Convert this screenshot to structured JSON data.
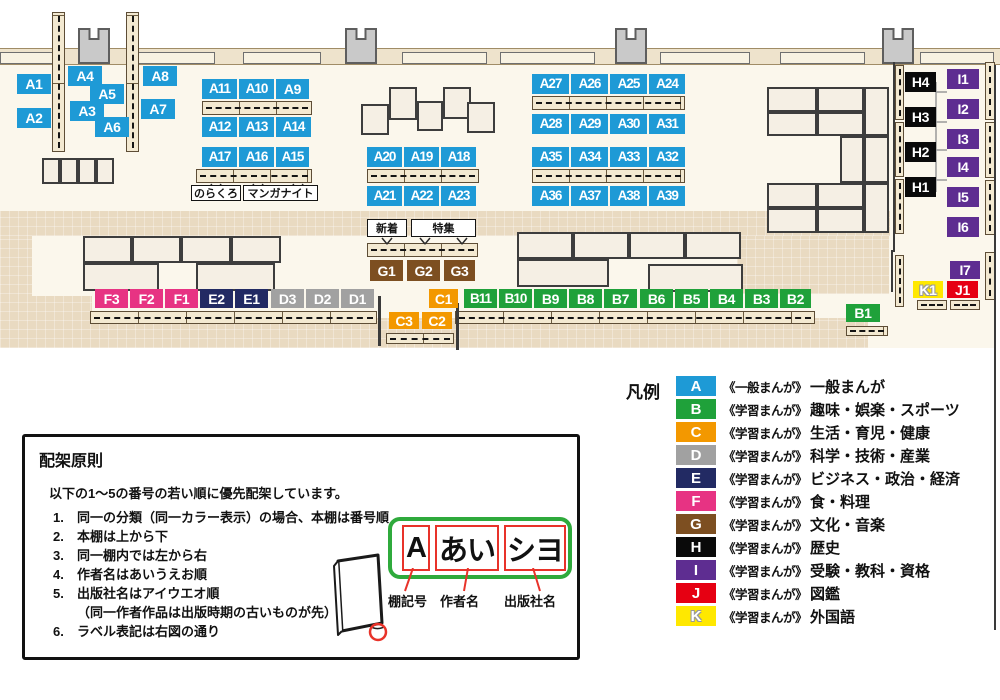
{
  "category_colors": {
    "A": "#1e9ad6",
    "B": "#1fa13a",
    "C": "#f39800",
    "D": "#a1a1a1",
    "E": "#222a63",
    "F": "#e73383",
    "G": "#7d4f21",
    "H": "#0a0a0a",
    "I": "#5e2d91",
    "J": "#e60012",
    "K": "#ffe800"
  },
  "map": {
    "shelf_labels": [
      {
        "id": "A1",
        "r": [
          17,
          74,
          34,
          20
        ]
      },
      {
        "id": "A4",
        "r": [
          68,
          66,
          34,
          20
        ]
      },
      {
        "id": "A8",
        "r": [
          143,
          66,
          34,
          20
        ]
      },
      {
        "id": "A5",
        "r": [
          90,
          84,
          34,
          20
        ]
      },
      {
        "id": "A2",
        "r": [
          17,
          108,
          34,
          20
        ]
      },
      {
        "id": "A3",
        "r": [
          70,
          101,
          34,
          20
        ]
      },
      {
        "id": "A7",
        "r": [
          141,
          99,
          34,
          20
        ]
      },
      {
        "id": "A6",
        "r": [
          95,
          117,
          34,
          20
        ]
      },
      {
        "id": "A11",
        "r": [
          202,
          79,
          35,
          20
        ]
      },
      {
        "id": "A10",
        "r": [
          239,
          79,
          35,
          20
        ]
      },
      {
        "id": "A9",
        "r": [
          276,
          79,
          33,
          20
        ]
      },
      {
        "id": "A12",
        "r": [
          202,
          117,
          35,
          20
        ]
      },
      {
        "id": "A13",
        "r": [
          239,
          117,
          35,
          20
        ]
      },
      {
        "id": "A14",
        "r": [
          276,
          117,
          35,
          20
        ]
      },
      {
        "id": "A17",
        "r": [
          202,
          147,
          35,
          20
        ]
      },
      {
        "id": "A16",
        "r": [
          239,
          147,
          35,
          20
        ]
      },
      {
        "id": "A15",
        "r": [
          276,
          147,
          33,
          20
        ]
      },
      {
        "id": "A20",
        "r": [
          367,
          147,
          35,
          20
        ]
      },
      {
        "id": "A19",
        "r": [
          404,
          147,
          35,
          20
        ]
      },
      {
        "id": "A18",
        "r": [
          441,
          147,
          35,
          20
        ]
      },
      {
        "id": "A21",
        "r": [
          367,
          186,
          35,
          20
        ]
      },
      {
        "id": "A22",
        "r": [
          404,
          186,
          35,
          20
        ]
      },
      {
        "id": "A23",
        "r": [
          441,
          186,
          35,
          20
        ]
      },
      {
        "id": "A27",
        "r": [
          532,
          74,
          37,
          20
        ]
      },
      {
        "id": "A26",
        "r": [
          571,
          74,
          37,
          20
        ]
      },
      {
        "id": "A25",
        "r": [
          610,
          74,
          37,
          20
        ]
      },
      {
        "id": "A24",
        "r": [
          649,
          74,
          36,
          20
        ]
      },
      {
        "id": "A28",
        "r": [
          532,
          114,
          37,
          20
        ]
      },
      {
        "id": "A29",
        "r": [
          571,
          114,
          37,
          20
        ]
      },
      {
        "id": "A30",
        "r": [
          610,
          114,
          37,
          20
        ]
      },
      {
        "id": "A31",
        "r": [
          649,
          114,
          36,
          20
        ]
      },
      {
        "id": "A35",
        "r": [
          532,
          147,
          37,
          20
        ]
      },
      {
        "id": "A34",
        "r": [
          571,
          147,
          37,
          20
        ]
      },
      {
        "id": "A33",
        "r": [
          610,
          147,
          37,
          20
        ]
      },
      {
        "id": "A32",
        "r": [
          649,
          147,
          36,
          20
        ]
      },
      {
        "id": "A36",
        "r": [
          532,
          186,
          37,
          20
        ]
      },
      {
        "id": "A37",
        "r": [
          571,
          186,
          37,
          20
        ]
      },
      {
        "id": "A38",
        "r": [
          610,
          186,
          37,
          20
        ]
      },
      {
        "id": "A39",
        "r": [
          649,
          186,
          36,
          20
        ]
      },
      {
        "id": "G1",
        "r": [
          370,
          260,
          33,
          21
        ]
      },
      {
        "id": "G2",
        "r": [
          407,
          260,
          33,
          21
        ]
      },
      {
        "id": "G3",
        "r": [
          444,
          260,
          31,
          21
        ]
      },
      {
        "id": "F3",
        "r": [
          95,
          289,
          33,
          19
        ]
      },
      {
        "id": "F2",
        "r": [
          130,
          289,
          33,
          19
        ]
      },
      {
        "id": "F1",
        "r": [
          165,
          289,
          33,
          19
        ]
      },
      {
        "id": "E2",
        "r": [
          200,
          289,
          33,
          19
        ]
      },
      {
        "id": "E1",
        "r": [
          235,
          289,
          33,
          19
        ]
      },
      {
        "id": "D3",
        "r": [
          271,
          289,
          33,
          19
        ]
      },
      {
        "id": "D2",
        "r": [
          306,
          289,
          33,
          19
        ]
      },
      {
        "id": "D1",
        "r": [
          341,
          289,
          33,
          19
        ]
      },
      {
        "id": "C1",
        "r": [
          429,
          289,
          29,
          19
        ]
      },
      {
        "id": "B11",
        "r": [
          464,
          289,
          33,
          19
        ]
      },
      {
        "id": "B10",
        "r": [
          499,
          289,
          33,
          19
        ]
      },
      {
        "id": "B9",
        "r": [
          534,
          289,
          33,
          19
        ]
      },
      {
        "id": "B8",
        "r": [
          569,
          289,
          33,
          19
        ]
      },
      {
        "id": "B7",
        "r": [
          604,
          289,
          33,
          19
        ]
      },
      {
        "id": "B6",
        "r": [
          640,
          289,
          33,
          19
        ]
      },
      {
        "id": "B5",
        "r": [
          675,
          289,
          33,
          19
        ]
      },
      {
        "id": "B4",
        "r": [
          710,
          289,
          33,
          19
        ]
      },
      {
        "id": "B3",
        "r": [
          745,
          289,
          33,
          19
        ]
      },
      {
        "id": "B2",
        "r": [
          780,
          289,
          31,
          19
        ]
      },
      {
        "id": "C3",
        "r": [
          389,
          312,
          30,
          17
        ]
      },
      {
        "id": "C2",
        "r": [
          422,
          312,
          30,
          17
        ]
      },
      {
        "id": "B1",
        "r": [
          846,
          304,
          34,
          18
        ]
      },
      {
        "id": "H4",
        "r": [
          905,
          72,
          31,
          20
        ]
      },
      {
        "id": "H3",
        "r": [
          905,
          107,
          31,
          20
        ]
      },
      {
        "id": "H2",
        "r": [
          905,
          142,
          31,
          20
        ]
      },
      {
        "id": "H1",
        "r": [
          905,
          177,
          31,
          20
        ]
      },
      {
        "id": "I1",
        "r": [
          947,
          69,
          32,
          20
        ]
      },
      {
        "id": "I2",
        "r": [
          947,
          99,
          32,
          20
        ]
      },
      {
        "id": "I3",
        "r": [
          947,
          129,
          32,
          20
        ]
      },
      {
        "id": "I4",
        "r": [
          947,
          157,
          32,
          20
        ]
      },
      {
        "id": "I5",
        "r": [
          947,
          187,
          32,
          20
        ]
      },
      {
        "id": "I6",
        "r": [
          947,
          217,
          32,
          20
        ]
      },
      {
        "id": "I7",
        "r": [
          950,
          261,
          30,
          18
        ]
      },
      {
        "id": "K1",
        "r": [
          913,
          281,
          30,
          17
        ]
      },
      {
        "id": "J1",
        "r": [
          947,
          281,
          31,
          17
        ]
      }
    ],
    "text_labels": [
      {
        "id": "norakuro",
        "text": "のらくろ",
        "r": [
          191,
          185,
          50,
          16
        ]
      },
      {
        "id": "manga-knight",
        "text": "マンガナイト",
        "r": [
          243,
          185,
          75,
          16
        ]
      },
      {
        "id": "new-arrivals",
        "text": "新着",
        "r": [
          367,
          219,
          40,
          18
        ]
      },
      {
        "id": "feature",
        "text": "特集",
        "r": [
          411,
          219,
          65,
          18
        ]
      }
    ]
  },
  "legend": {
    "title": "凡例",
    "items": [
      {
        "code": "A",
        "series": "《一般まんが》",
        "label": "一般まんが"
      },
      {
        "code": "B",
        "series": "《学習まんが》",
        "label": "趣味・娯楽・スポーツ"
      },
      {
        "code": "C",
        "series": "《学習まんが》",
        "label": "生活・育児・健康"
      },
      {
        "code": "D",
        "series": "《学習まんが》",
        "label": "科学・技術・産業"
      },
      {
        "code": "E",
        "series": "《学習まんが》",
        "label": "ビジネス・政治・経済"
      },
      {
        "code": "F",
        "series": "《学習まんが》",
        "label": "食・料理"
      },
      {
        "code": "G",
        "series": "《学習まんが》",
        "label": "文化・音楽"
      },
      {
        "code": "H",
        "series": "《学習まんが》",
        "label": "歴史"
      },
      {
        "code": "I",
        "series": "《学習まんが》",
        "label": "受験・教科・資格"
      },
      {
        "code": "J",
        "series": "《学習まんが》",
        "label": "図鑑"
      },
      {
        "code": "K",
        "series": "《学習まんが》",
        "label": "外国語"
      }
    ]
  },
  "principles": {
    "title": "配架原則",
    "intro": "以下の1～5の番号の若い順に優先配架しています。",
    "items": [
      {
        "n": "1.",
        "t": "同一の分類（同一カラー表示）の場合、本棚は番号順"
      },
      {
        "n": "2.",
        "t": "本棚は上から下"
      },
      {
        "n": "3.",
        "t": "同一棚内では左から右"
      },
      {
        "n": "4.",
        "t": "作者名はあいうえお順"
      },
      {
        "n": "5.",
        "t": "出版社名はアイウエオ順",
        "note": "（同一作者作品は出版時期の古いものが先）"
      },
      {
        "n": "6.",
        "t": "ラベル表記は右図の通り"
      }
    ]
  },
  "label_diagram": {
    "boxes": [
      {
        "text": "A",
        "w": 28
      },
      {
        "text": "あい",
        "w": 64
      },
      {
        "text": "シヨ",
        "w": 62
      }
    ],
    "captions": [
      "棚記号",
      "作者名",
      "出版社名"
    ]
  }
}
